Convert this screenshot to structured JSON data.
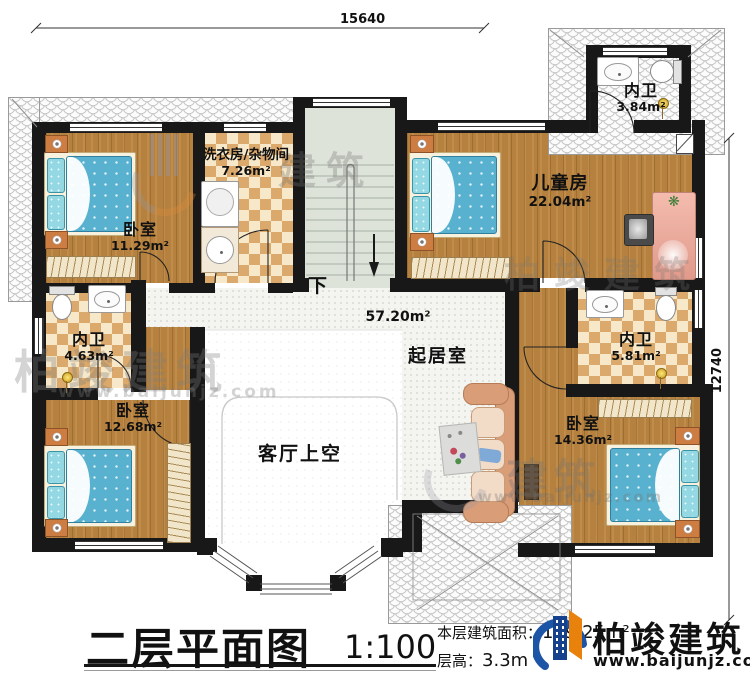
{
  "dimensions": {
    "top": "15640",
    "right": "12740"
  },
  "rooms": {
    "bedroom_tl": {
      "name": "卧室",
      "area": "11.29m²"
    },
    "laundry": {
      "name": "洗衣房/杂物间",
      "area": "7.26m²"
    },
    "children": {
      "name": "儿童房",
      "area": "22.04m²"
    },
    "bath_top": {
      "name": "内卫",
      "area": "3.84m²"
    },
    "bath_left": {
      "name": "内卫",
      "area": "4.63m²"
    },
    "bath_right": {
      "name": "内卫",
      "area": "5.81m²"
    },
    "bedroom_bl": {
      "name": "卧室",
      "area": "12.68m²"
    },
    "bedroom_br": {
      "name": "卧室",
      "area": "14.36m²"
    },
    "living": {
      "name": "起居室",
      "area": "57.20m²"
    },
    "void": {
      "name": "客厅上空"
    }
  },
  "stairs": {
    "down_label": "下"
  },
  "title_block": {
    "title": "二层平面图",
    "scale": "1:100",
    "area_label": "本层建筑面积：",
    "area_value": "139.25m²",
    "height_label": "层高：",
    "height_value": "3.3m"
  },
  "logo": {
    "name": "柏竣建筑",
    "url": "www.baijunjz.com"
  },
  "watermark": {
    "brand": "柏竣建筑",
    "brand_short": "建筑",
    "url": "www.baijunjz.com"
  },
  "colors": {
    "wall": "#181818",
    "wood_floor": "#b6813e",
    "tile_tan": "#dba96b",
    "mattress_blue": "#58b1cf",
    "pillow_cyan": "#93d8e2",
    "stair_green": "#dde3d9",
    "logo_blue": "#1d55a6",
    "logo_orange": "#e8820c"
  }
}
